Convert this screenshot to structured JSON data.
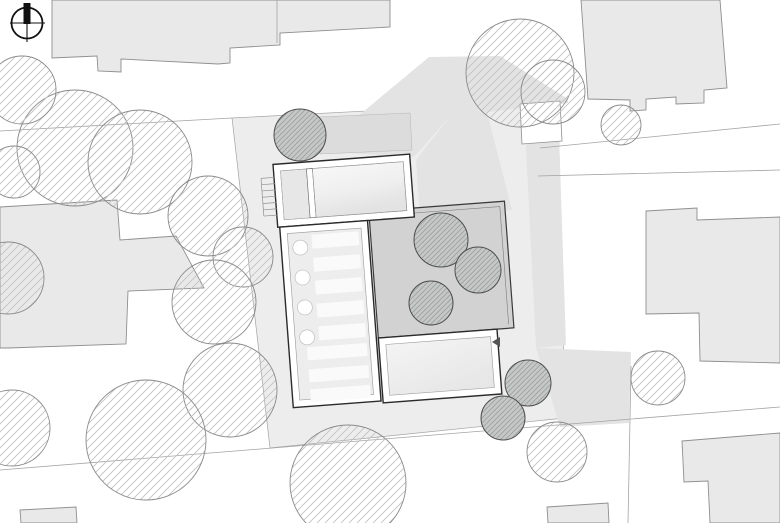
{
  "title": "Architectural site plan drawing",
  "canvas": {
    "width": 780,
    "height": 523,
    "background": "#ffffff"
  },
  "colors": {
    "background": "#ffffff",
    "parcel": "#ededed",
    "shadow": "#e3e3e3",
    "garden": "#dcdcdc",
    "courtyard": "#d2d2d2",
    "building_fill": "#e9e9e9",
    "building_stroke": "#8f8f8f",
    "wall_stroke": "#2b2b2b",
    "inner_stroke": "#9a9a9a",
    "room_fill": "#f1f1f1",
    "room_fill_dark": "#e7e7e7",
    "stripe": "#fafafa",
    "line": "#a3a3a3",
    "tree_stroke": "#8a8a8a",
    "tree_hatch": "#c2c2c2",
    "tree_fill": "#c5c8c7",
    "tree_fill_hatch": "#9aa09e",
    "tree_fill_stroke": "#4d4d4d",
    "north": "#111111",
    "marker": "#555555"
  },
  "north_arrow": {
    "cx": 27,
    "cy": 23,
    "r": 15.5,
    "v_line": [
      27,
      3,
      27,
      42
    ],
    "h_line": [
      10,
      23,
      45,
      23
    ],
    "needle": {
      "x": 23.5,
      "y": 3,
      "w": 7,
      "h": 21
    }
  },
  "parcel": {
    "points": "232,118 558,101 565,418 270,448"
  },
  "shadows": [
    {
      "name": "shadow-northeast",
      "points": "316,151 429,57 500,56 568,99 568,103 487,112 452,114 414,157"
    },
    {
      "name": "shadow-gap",
      "points": "416,160 452,114 487,112 512,210 420,219"
    },
    {
      "name": "shadow-east-strip",
      "points": "524,107 558,104 566,345 536,348"
    },
    {
      "name": "shadow-southeast-spill",
      "points": "536,348 631,352 629,423 560,427"
    }
  ],
  "garden_bed": {
    "points": "318,117 410,113 412,150 320,154"
  },
  "context_buildings": [
    {
      "name": "building-north-row",
      "points": "52,0 390,0 390,27 280,33 280,45 230,48 230,63 218,64 121,59 121,72 98,71 97,56 52,58"
    },
    {
      "name": "building-northeast",
      "points": "581,0 720,0 727,88 704,90 704,103 676,104 676,97 646,99 646,110 630,111 630,100 588,99"
    },
    {
      "name": "building-east",
      "points": "646,211 697,208 697,220 780,217 780,363 700,361 699,313 646,314"
    },
    {
      "name": "building-west",
      "points": "0,207 117,200 120,240 176,236 204,288 128,291 126,344 8,348 0,348"
    },
    {
      "name": "building-southeast",
      "points": "682,441 780,433 780,523 710,523 708,481 684,482"
    },
    {
      "name": "building-south-small",
      "points": "547,507 608,503 609,523 548,523"
    },
    {
      "name": "building-southwest-small",
      "points": "20,510 76,507 77,523 21,523"
    }
  ],
  "shed": {
    "points": "520,104 560,101 562,141 522,144"
  },
  "property_lines": [
    {
      "x1": 0,
      "y1": 131,
      "x2": 232,
      "y2": 118
    },
    {
      "x1": 540,
      "y1": 148,
      "x2": 780,
      "y2": 124
    },
    {
      "x1": 538,
      "y1": 176,
      "x2": 780,
      "y2": 170
    },
    {
      "x1": 0,
      "y1": 470,
      "x2": 780,
      "y2": 407
    },
    {
      "x1": 631,
      "y1": 366,
      "x2": 628,
      "y2": 523
    },
    {
      "x1": 277,
      "y1": 0,
      "x2": 277,
      "y2": 43
    }
  ],
  "site_building": {
    "rotation": {
      "angle": -4.3,
      "cx": 390,
      "cy": 280
    },
    "inner_inset": 7,
    "courtyard": {
      "x": 374,
      "y": 210,
      "w": 136,
      "h": 127
    },
    "top_wing": {
      "x": 282,
      "y": 156,
      "w": 137,
      "h": 63,
      "left_room_w": 26,
      "divider_w": 6
    },
    "left_wing": {
      "x": 284,
      "y": 219,
      "w": 88,
      "h": 181
    },
    "bottom_room": {
      "x": 374,
      "y": 337,
      "w": 119,
      "h": 65
    },
    "columns": {
      "cx": 303,
      "r": 7.5,
      "cys": [
        241,
        271,
        301,
        331
      ]
    },
    "stripes_upper": {
      "x": 315,
      "w": 47,
      "h": 14,
      "ys": [
        229,
        252,
        275,
        298,
        321
      ]
    },
    "stripes_lower": {
      "x": 302,
      "w": 60,
      "h": 13,
      "ys": [
        341,
        363,
        383
      ]
    },
    "entry_stairs": {
      "x1": 269,
      "x2": 283,
      "y_top": 169,
      "steps": 7,
      "step_gap": 6.3
    }
  },
  "marker_arrow": {
    "points": "500,337 492,342 500,347"
  },
  "trees": {
    "outlined": [
      {
        "cx": 75,
        "cy": 148,
        "r": 58
      },
      {
        "cx": 140,
        "cy": 162,
        "r": 52
      },
      {
        "cx": 22,
        "cy": 90,
        "r": 34
      },
      {
        "cx": 14,
        "cy": 172,
        "r": 26
      },
      {
        "cx": 8,
        "cy": 278,
        "r": 36
      },
      {
        "cx": 208,
        "cy": 216,
        "r": 40
      },
      {
        "cx": 243,
        "cy": 257,
        "r": 30
      },
      {
        "cx": 214,
        "cy": 302,
        "r": 42
      },
      {
        "cx": 230,
        "cy": 390,
        "r": 47
      },
      {
        "cx": 146,
        "cy": 440,
        "r": 60
      },
      {
        "cx": 12,
        "cy": 428,
        "r": 38
      },
      {
        "cx": 348,
        "cy": 483,
        "r": 58
      },
      {
        "cx": 520,
        "cy": 73,
        "r": 54
      },
      {
        "cx": 553,
        "cy": 92,
        "r": 32
      },
      {
        "cx": 658,
        "cy": 378,
        "r": 27
      },
      {
        "cx": 557,
        "cy": 452,
        "r": 30
      },
      {
        "cx": 621,
        "cy": 125,
        "r": 20
      }
    ],
    "filled": [
      {
        "cx": 300,
        "cy": 135,
        "r": 26
      },
      {
        "cx": 441,
        "cy": 240,
        "r": 27
      },
      {
        "cx": 478,
        "cy": 270,
        "r": 23
      },
      {
        "cx": 431,
        "cy": 303,
        "r": 22
      },
      {
        "cx": 528,
        "cy": 383,
        "r": 23
      },
      {
        "cx": 503,
        "cy": 418,
        "r": 22
      }
    ]
  }
}
